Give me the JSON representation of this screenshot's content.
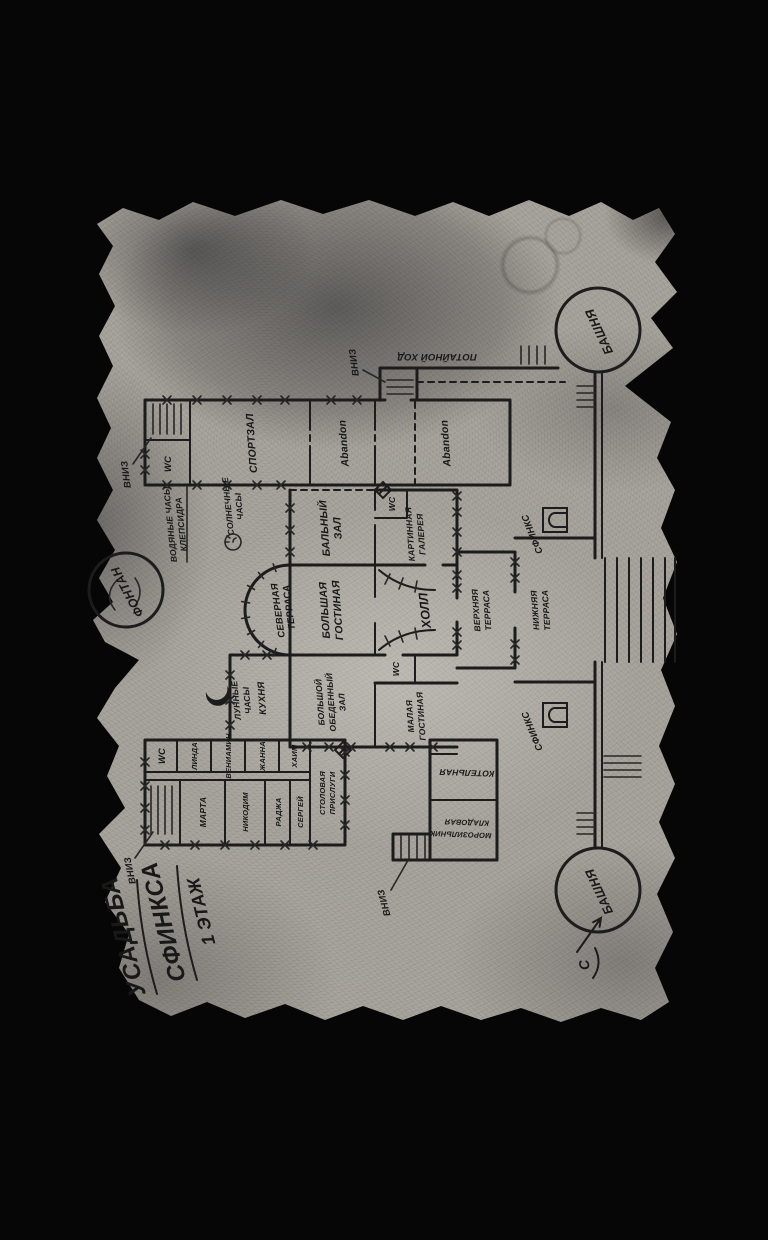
{
  "map": {
    "title": [
      "УСАДЬБА",
      "СФИНКСА",
      "1 ЭТАЖ"
    ],
    "labels": {
      "fountain": "ФОНТАН",
      "tower": "БАШНЯ",
      "sphinx": "СФИНКС",
      "hall": "ХОЛЛ",
      "gym": "СПОРТЗАЛ",
      "abandon": "Abandon",
      "kitchen": "КУХНЯ",
      "boiler": "КОТЕЛЬНАЯ",
      "wc": "WC",
      "down": "ВНИЗ",
      "secret_passage": "ПОТАЙНОЙ ХОД",
      "compass_north": "С"
    },
    "rooms_multiline": {
      "north_terrace": [
        "СЕВЕРНАЯ",
        "ТЕРРАСА"
      ],
      "big_living": [
        "БОЛЬШАЯ",
        "ГОСТИНАЯ"
      ],
      "upper_terrace": [
        "ВЕРХНЯЯ",
        "ТЕРРАСА"
      ],
      "lower_terrace": [
        "НИЖНЯЯ",
        "ТЕРРАСА"
      ],
      "ballroom": [
        "БАЛЬНЫЙ",
        "ЗАЛ"
      ],
      "gallery": [
        "КАРТИННАЯ",
        "ГАЛЕРЕЯ"
      ],
      "dining_hall": [
        "БОЛЬШОЙ",
        "ОБЕДЕННЫЙ",
        "ЗАЛ"
      ],
      "small_living": [
        "МАЛАЯ",
        "ГОСТИНАЯ"
      ],
      "servants_dining": [
        "СТОЛОВАЯ",
        "ПРИСЛУГИ"
      ],
      "freezer": [
        "МОРОЗИЛЬНИК",
        "КЛАДОВАЯ"
      ],
      "water_clock": [
        "ВОДЯНЫЕ ЧАСЫ",
        "КЛЕПСИДРА"
      ],
      "sundial": [
        "СОЛНЕЧНЫЕ",
        "ЧАСЫ"
      ],
      "moon_clock": [
        "ЛУННЫЕ",
        "ЧАСЫ"
      ]
    },
    "servant_rooms": {
      "west": [
        "МАРТА",
        "НИКОДИМ",
        "РАДЖА",
        "СЕРГЕЙ"
      ],
      "east": [
        "ЛИНДА",
        "ВЕНИАМИН",
        "ЖАННА",
        "ХАИМ"
      ]
    },
    "colors": {
      "page_bg": "#060606",
      "parchment": "#a9a59e",
      "ink": "#1c1c1c"
    }
  }
}
